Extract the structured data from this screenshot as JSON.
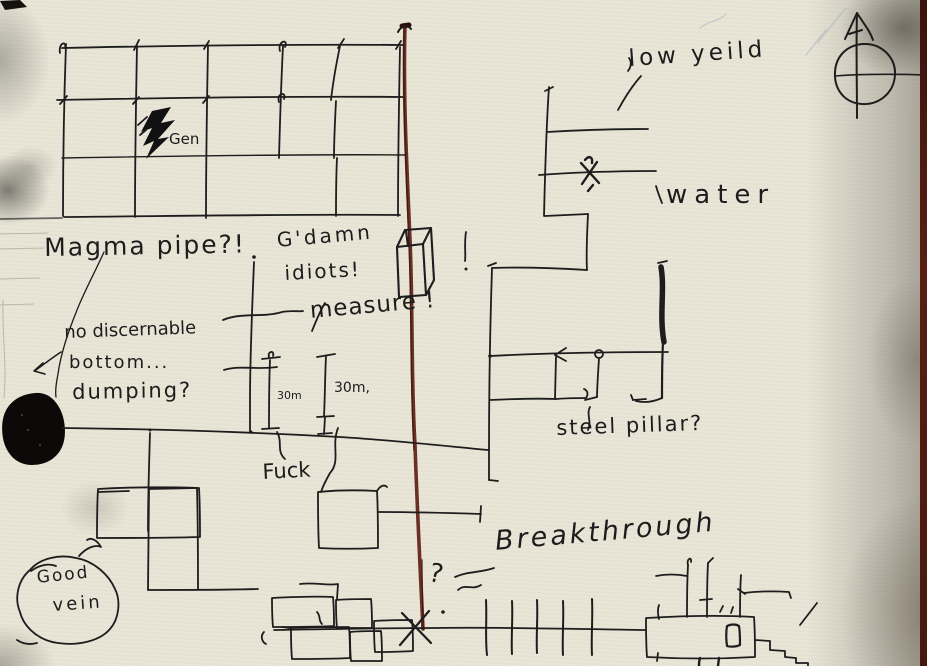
{
  "document": {
    "kind": "hand-drawn mine survey sketch on paper",
    "paper_color": "#e9e6d8",
    "ink_color": "#1d1d1d",
    "survey_line_color": "#5d231a"
  },
  "annotations": {
    "gen": "Gen",
    "low_yield": "low yeild",
    "water": "water",
    "magma_pipe": "Magma pipe?!",
    "gdamn_line1": "G'damn",
    "gdamn_line2": "idiots!",
    "measure": "measure !",
    "no_bottom_line1": "no discernable",
    "no_bottom_line2": "bottom...",
    "no_bottom_line3": "dumping?",
    "depth_small": "30m",
    "depth_large": "30m,",
    "fuck": "Fuck",
    "steel_pillar": "steel pillar?",
    "breakthrough": "Breakthrough",
    "good_vein_line1": "Good",
    "good_vein_line2": "vein",
    "unknown_mark": "?"
  },
  "symbols": {
    "compass_rose": "circle with north arrow",
    "generator": "lightning bolt",
    "water_hazard_marker": "x-mark",
    "collapse_marker": "x-mark over red line end",
    "pit_hole": "solid black blob",
    "survey_line": "dark red vertical line",
    "measured_span": "30m I-beam dimension marks"
  }
}
